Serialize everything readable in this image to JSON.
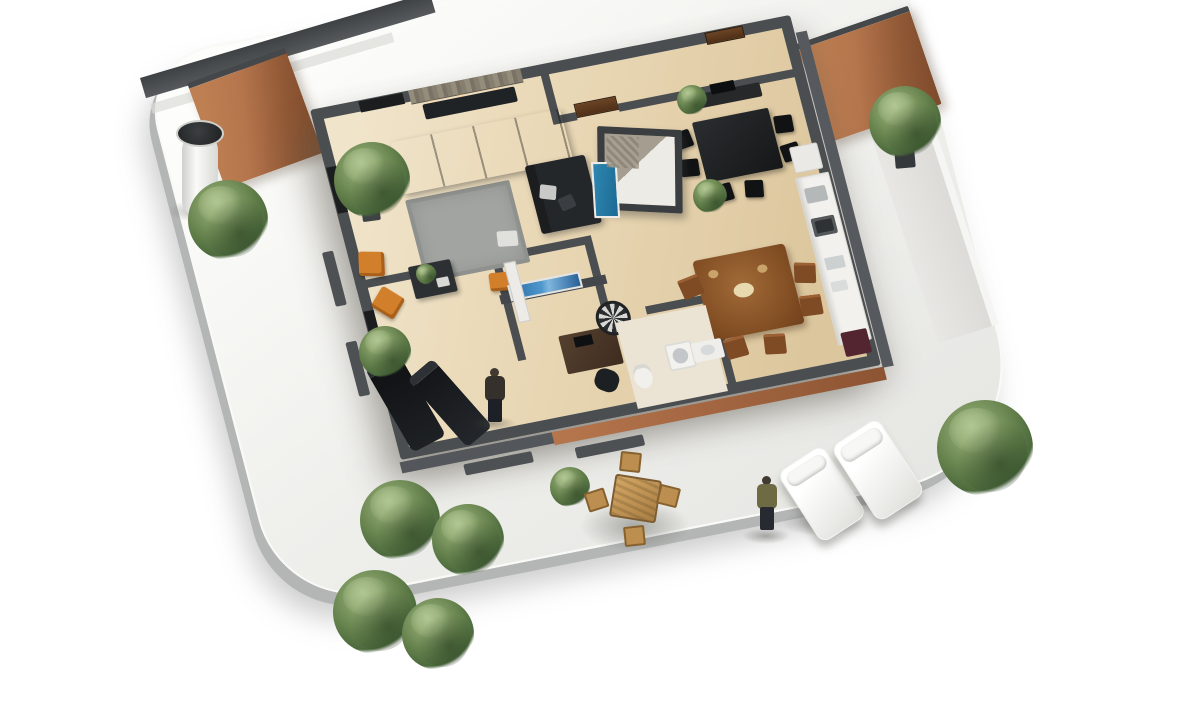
{
  "meta": {
    "description": "3D isometric rendering of an apartment floor plan on a curved white terrace",
    "visible_text": "none"
  },
  "palette": {
    "wall_dark": "#4b4e50",
    "terracotta": "#b5764e",
    "floor_beige": "#e8d6b4",
    "floor_light": "#f0e4cb",
    "terrace": "#efefec",
    "terrace_edge": "#b4b6b5",
    "sofa": "#24272a",
    "rug": "#a2a4a1",
    "orange": "#d07f2c",
    "wood": "#804d24",
    "wood_chair": "#7e4b26",
    "blue_door": "#2f87b0",
    "blue_tv": "#4f97cc",
    "plant": "#66824e",
    "plant_dark": "#4c6a3e",
    "stone": "#948d7c",
    "olive": "#6e6a45",
    "maroon": "#522531"
  },
  "scene": {
    "rooms": [
      "living-room",
      "dining-area",
      "hallway",
      "shower-cube",
      "kitchen",
      "wood-dining-corner",
      "study",
      "bathroom",
      "lounge"
    ],
    "interior_objects": [
      "l-shaped-sofa",
      "grey-rug",
      "coffee-table",
      "orange-armchairs",
      "stone-accent-wall",
      "media-console",
      "dark-dining-table",
      "black-chairs",
      "sideboard",
      "shower-cube-with-blue-door",
      "kitchen-counter",
      "sink",
      "stove",
      "wood-dining-table",
      "wood-chairs",
      "desk",
      "office-chair",
      "wall-tv-blue",
      "round-patterned-disc",
      "wardrobe",
      "toilet",
      "washing-machine",
      "basin",
      "chaise-lounges",
      "standing-person"
    ],
    "exterior_objects": [
      "curved-terrace",
      "white-column",
      "dark-boundary-wall",
      "terracotta-privacy-walls",
      "side-walkway",
      "potted-palms",
      "outdoor-dining-set",
      "standing-person",
      "sun-loungers",
      "curb-walls"
    ]
  }
}
